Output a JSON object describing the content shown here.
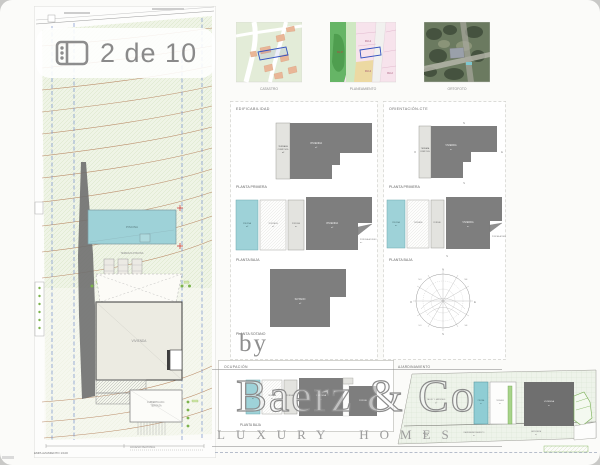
{
  "badge": {
    "count_label": "2 de 10"
  },
  "watermark": {
    "by": "by",
    "brand": "Baerz & Co",
    "tagline": "LUXURY HOMES"
  },
  "plans": {
    "piscina": "PISCINA",
    "terraza": "TERRAZA",
    "porche": "PORCHE",
    "vivienda": "VIVIENDA",
    "porche_acceso": "PORCHE ACCESO",
    "sotano": "SOTANO",
    "terraza_line1": "TERRAZA",
    "terraza_line2": "COMP. 50%",
    "sqm": "m²"
  },
  "site_plan": {
    "caption": "EMPLAZAMIENTO 1/100",
    "access_note": "ACCESO PEATONAL",
    "pool": "PISCINA",
    "pool_terrace": "TERRAZA PISCINA",
    "house": "VIVIENDA",
    "annex_line1": "CUBIERTA ACC.",
    "annex_line2": "TERRAZA"
  },
  "maps": {
    "catastro": {
      "label": "CATASTRO"
    },
    "planeamiento": {
      "label": "PLANEAMIENTO",
      "zones": [
        "RL-P",
        "RU-2",
        "RU-2",
        "RU-2"
      ]
    },
    "ortofoto": {
      "label": "ORTOFOTO"
    }
  },
  "edificabilidad": {
    "title": "EDIFICABILIDAD",
    "caption_primera": "PLANTA PRIMERA",
    "caption_baja": "PLANTA BAJA",
    "caption_sotano": "PLANTA SOTANO"
  },
  "orientacion": {
    "title": "ORIENTACIÓN-CTE",
    "caption_primera": "PLANTA PRIMERA",
    "caption_baja": "PLANTA BAJA",
    "compass": [
      "N",
      "NE",
      "E",
      "SE",
      "S",
      "SO",
      "O",
      "NO"
    ]
  },
  "ocupacion": {
    "title": "OCUPACIÓN",
    "caption": "PLANTA BAJA"
  },
  "ajardinamiento": {
    "title": "AJARDINAMIENTO",
    "talud": "TALUD Y JARDINES",
    "acera": "ACERA",
    "rampa": "RAMPA APARCAMIENTO",
    "jardinera": "JARDINERA"
  },
  "colors": {
    "pool_teal": "#9ed2d8",
    "plan_dark_gray": "#7e7e7e",
    "plan_light_gray": "#e3e3df",
    "terrain_green": "#eff4e6",
    "contour_brown": "#bb8d6a",
    "boundary_blue": "#7590cc",
    "vegetation_green": "#7cb34d",
    "watermark_gray": "#8f8f8f",
    "badge_text_gray": "#8a8a8a"
  }
}
